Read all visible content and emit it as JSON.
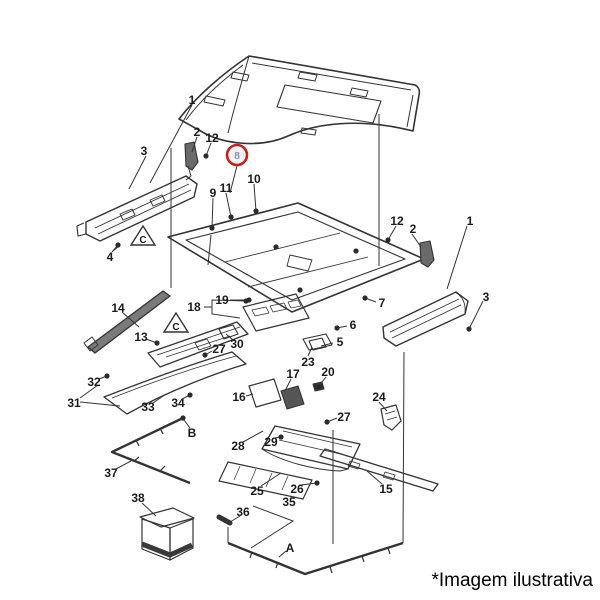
{
  "page": {
    "caption": "*Imagem ilustrativa",
    "background": "#ffffff"
  },
  "diagram": {
    "stroke_color": "#333333",
    "label_color": "#1b1b1b",
    "highlight": {
      "label": "8",
      "cx": 237,
      "cy": 155,
      "r": 10,
      "ring_color": "#c4201d",
      "fill": "#f2f3f5",
      "text_color": "#8795aa"
    },
    "triangles": [
      {
        "label": "C",
        "cx": 143,
        "cy": 237
      },
      {
        "label": "C",
        "cx": 176,
        "cy": 324
      }
    ],
    "callouts": [
      {
        "label": "1",
        "x": 192,
        "y": 100
      },
      {
        "label": "3",
        "x": 144,
        "y": 151
      },
      {
        "label": "2",
        "x": 197,
        "y": 132
      },
      {
        "label": "12",
        "x": 212,
        "y": 138
      },
      {
        "label": "9",
        "x": 213,
        "y": 193
      },
      {
        "label": "11",
        "x": 226,
        "y": 188
      },
      {
        "label": "10",
        "x": 254,
        "y": 179
      },
      {
        "label": "4",
        "x": 110,
        "y": 257
      },
      {
        "label": "12",
        "x": 397,
        "y": 221
      },
      {
        "label": "2",
        "x": 413,
        "y": 229
      },
      {
        "label": "1",
        "x": 470,
        "y": 221
      },
      {
        "label": "3",
        "x": 486,
        "y": 297
      },
      {
        "label": "7",
        "x": 382,
        "y": 303
      },
      {
        "label": "19",
        "x": 222,
        "y": 300
      },
      {
        "label": "18",
        "x": 194,
        "y": 307
      },
      {
        "label": "14",
        "x": 118,
        "y": 308
      },
      {
        "label": "13",
        "x": 141,
        "y": 337
      },
      {
        "label": "30",
        "x": 237,
        "y": 344
      },
      {
        "label": "27",
        "x": 219,
        "y": 349
      },
      {
        "label": "6",
        "x": 353,
        "y": 325
      },
      {
        "label": "5",
        "x": 340,
        "y": 342
      },
      {
        "label": "23",
        "x": 308,
        "y": 362
      },
      {
        "label": "20",
        "x": 328,
        "y": 372
      },
      {
        "label": "17",
        "x": 293,
        "y": 374
      },
      {
        "label": "16",
        "x": 239,
        "y": 397
      },
      {
        "label": "24",
        "x": 379,
        "y": 397
      },
      {
        "label": "27",
        "x": 344,
        "y": 417
      },
      {
        "label": "32",
        "x": 94,
        "y": 382
      },
      {
        "label": "31",
        "x": 74,
        "y": 403
      },
      {
        "label": "33",
        "x": 148,
        "y": 407
      },
      {
        "label": "34",
        "x": 178,
        "y": 403
      },
      {
        "label": "28",
        "x": 238,
        "y": 446
      },
      {
        "label": "29",
        "x": 271,
        "y": 442
      },
      {
        "label": "B",
        "x": 192,
        "y": 433
      },
      {
        "label": "37",
        "x": 111,
        "y": 473
      },
      {
        "label": "38",
        "x": 138,
        "y": 498
      },
      {
        "label": "25",
        "x": 257,
        "y": 491
      },
      {
        "label": "26",
        "x": 297,
        "y": 489
      },
      {
        "label": "35",
        "x": 289,
        "y": 502
      },
      {
        "label": "36",
        "x": 243,
        "y": 512
      },
      {
        "label": "A",
        "x": 290,
        "y": 548
      },
      {
        "label": "15",
        "x": 386,
        "y": 489
      }
    ],
    "leaders": [
      {
        "pts": [
          [
            192,
            105
          ],
          [
            150,
            183
          ]
        ]
      },
      {
        "pts": [
          [
            146,
            156
          ],
          [
            129,
            189
          ]
        ]
      },
      {
        "pts": [
          [
            197,
            137
          ],
          [
            192,
            152
          ]
        ]
      },
      {
        "pts": [
          [
            211,
            143
          ],
          [
            206,
            156
          ]
        ],
        "dot": true
      },
      {
        "pts": [
          [
            237,
            166
          ],
          [
            230,
            193
          ]
        ]
      },
      {
        "pts": [
          [
            213,
            198
          ],
          [
            212,
            228
          ]
        ],
        "dot": true
      },
      {
        "pts": [
          [
            226,
            193
          ],
          [
            231,
            217
          ]
        ],
        "dot": true
      },
      {
        "pts": [
          [
            254,
            184
          ],
          [
            256,
            211
          ]
        ],
        "dot": true
      },
      {
        "pts": [
          [
            112,
            252
          ],
          [
            118,
            245
          ]
        ],
        "dot": true
      },
      {
        "pts": [
          [
            396,
            226
          ],
          [
            388,
            240
          ]
        ],
        "dot": true
      },
      {
        "pts": [
          [
            412,
            234
          ],
          [
            421,
            247
          ]
        ]
      },
      {
        "pts": [
          [
            467,
            226
          ],
          [
            447,
            289
          ]
        ]
      },
      {
        "pts": [
          [
            483,
            301
          ],
          [
            469,
            329
          ]
        ],
        "dot": true
      },
      {
        "pts": [
          [
            376,
            302
          ],
          [
            365,
            298
          ]
        ],
        "dot": true
      },
      {
        "pts": [
          [
            204,
            307
          ],
          [
            212,
            307
          ],
          [
            212,
            300
          ],
          [
            246,
            301
          ]
        ],
        "dot": true
      },
      {
        "pts": [
          [
            212,
            307
          ],
          [
            212,
            314
          ],
          [
            240,
            318
          ]
        ]
      },
      {
        "pts": [
          [
            230,
            300
          ],
          [
            249,
            300
          ]
        ],
        "dot": true
      },
      {
        "pts": [
          [
            122,
            312
          ],
          [
            139,
            327
          ]
        ]
      },
      {
        "pts": [
          [
            146,
            339
          ],
          [
            157,
            343
          ]
        ],
        "dot": true
      },
      {
        "pts": [
          [
            233,
            340
          ],
          [
            226,
            334
          ]
        ]
      },
      {
        "pts": [
          [
            212,
            351
          ],
          [
            205,
            355
          ]
        ],
        "dot": true
      },
      {
        "pts": [
          [
            347,
            326
          ],
          [
            337,
            328
          ]
        ],
        "dot": true
      },
      {
        "pts": [
          [
            333,
            343
          ],
          [
            321,
            346
          ]
        ]
      },
      {
        "pts": [
          [
            308,
            356
          ],
          [
            312,
            347
          ]
        ]
      },
      {
        "pts": [
          [
            326,
            377
          ],
          [
            318,
            387
          ]
        ],
        "dot": true
      },
      {
        "pts": [
          [
            291,
            379
          ],
          [
            285,
            391
          ]
        ]
      },
      {
        "pts": [
          [
            246,
            396
          ],
          [
            253,
            394
          ]
        ]
      },
      {
        "pts": [
          [
            379,
            402
          ],
          [
            387,
            411
          ]
        ]
      },
      {
        "pts": [
          [
            337,
            418
          ],
          [
            327,
            422
          ]
        ],
        "dot": true
      },
      {
        "pts": [
          [
            99,
            379
          ],
          [
            107,
            376
          ]
        ],
        "dot": true
      },
      {
        "pts": [
          [
            80,
            398
          ],
          [
            98,
            385
          ]
        ]
      },
      {
        "pts": [
          [
            80,
            402
          ],
          [
            120,
            406
          ]
        ]
      },
      {
        "pts": [
          [
            153,
            403
          ],
          [
            166,
            394
          ]
        ]
      },
      {
        "pts": [
          [
            182,
            399
          ],
          [
            190,
            395
          ]
        ],
        "dot": true
      },
      {
        "pts": [
          [
            243,
            442
          ],
          [
            263,
            431
          ]
        ]
      },
      {
        "pts": [
          [
            275,
            438
          ],
          [
            281,
            437
          ]
        ],
        "dot": true
      },
      {
        "pts": [
          [
            261,
            486
          ],
          [
            281,
            473
          ]
        ]
      },
      {
        "pts": [
          [
            301,
            485
          ],
          [
            317,
            483
          ]
        ],
        "dot": true
      },
      {
        "pts": [
          [
            253,
            506
          ],
          [
            293,
            521
          ],
          [
            251,
            548
          ]
        ]
      },
      {
        "pts": [
          [
            240,
            516
          ],
          [
            230,
            522
          ]
        ]
      },
      {
        "pts": [
          [
            116,
            469
          ],
          [
            131,
            461
          ]
        ]
      },
      {
        "pts": [
          [
            142,
            503
          ],
          [
            156,
            516
          ]
        ]
      },
      {
        "pts": [
          [
            382,
            484
          ],
          [
            367,
            471
          ]
        ]
      },
      {
        "pts": [
          [
            190,
            428
          ],
          [
            184,
            420
          ]
        ]
      },
      {
        "pts": [
          [
            286,
            551
          ],
          [
            279,
            557
          ]
        ]
      },
      {
        "pts": [
          [
            171,
            148
          ],
          [
            171,
            288
          ]
        ]
      },
      {
        "pts": [
          [
            379,
            114
          ],
          [
            379,
            266
          ]
        ]
      },
      {
        "pts": [
          [
            404,
            352
          ],
          [
            403,
            543
          ]
        ]
      },
      {
        "pts": [
          [
            333,
            430
          ],
          [
            333,
            544
          ]
        ]
      }
    ],
    "dots": [
      [
        183,
        418
      ],
      [
        276,
        247
      ],
      [
        356,
        251
      ],
      [
        300,
        290
      ]
    ],
    "shapes": [
      {
        "d": "M179,119 C196,97 222,74 249,56 L415,85 C419,87 420,91 419,95 L413,131 C358,117 314,124 288,136 C259,149 224,143 206,134 Z",
        "w": 1.6
      },
      {
        "d": "M249,56 C242,81 234,108 228,133",
        "w": 1
      },
      {
        "d": "M186,120 C200,101 220,82 243,65",
        "w": 1
      },
      {
        "d": "M252,63 L411,90",
        "w": 1
      },
      {
        "d": "M413,95 L407,127",
        "w": 1
      },
      {
        "d": "M285,85 L381,101 L373,123 L277,107 Z",
        "w": 1.1
      },
      {
        "d": "M206,96 l19,4 l-2,6 l-19,-4 Z",
        "w": 1
      },
      {
        "d": "M233,72 l16,3 l-2,6 l-16,-3 Z",
        "w": 1
      },
      {
        "d": "M300,72 l17,3 l-2,6 l-17,-3 Z",
        "w": 1
      },
      {
        "d": "M352,88 l16,3 l-2,6 l-16,-3 Z",
        "w": 1
      },
      {
        "d": "M302,128 l14,2 l-1,5 l-14,-2 Z",
        "w": 1
      },
      {
        "d": "M86,222 L186,176 L197,184 L194,197 L100,241 L86,234 Z",
        "w": 1.4
      },
      {
        "d": "M95,228 L189,184",
        "w": 0.9
      },
      {
        "d": "M98,234 L191,190",
        "w": 0.9
      },
      {
        "d": "M120,214 l12,-5 l3,6 l-12,5 Z",
        "w": 0.9
      },
      {
        "d": "M150,200 l12,-5 l3,6 l-12,5 Z",
        "w": 0.9
      },
      {
        "d": "M84,223 l-7,3 l1,10 l8,-2",
        "w": 1.1
      },
      {
        "d": "M185,144 l9,-2 l4,20 l-6,8 l-6,-4 Z",
        "w": 1.1,
        "f": "#6a6a6a"
      },
      {
        "d": "M188,166 l3,10 l-5,4",
        "w": 1
      },
      {
        "d": "M113,251 L120,245",
        "w": 1
      },
      {
        "d": "M211,235 L208,265",
        "w": 1
      },
      {
        "d": "M168,237 L298,203 L424,259 L292,312 Z",
        "w": 1.6
      },
      {
        "d": "M186,240 L298,212 L405,259 L292,300 Z",
        "w": 1.1
      },
      {
        "d": "M225,262 L340,233",
        "w": 0.9
      },
      {
        "d": "M248,287 L368,257",
        "w": 0.9
      },
      {
        "d": "M290,255 l22,5 l-4,11 l-21,-5 Z",
        "w": 0.9
      },
      {
        "d": "M243,307 L296,294 L309,318 L256,331 Z",
        "w": 1.2
      },
      {
        "d": "M252,310 l14,-3 l3,6 l-14,3 Z",
        "w": 0.8
      },
      {
        "d": "M270,306 l14,-3 l3,6 l-14,3 Z",
        "w": 0.8
      },
      {
        "d": "M288,302 l10,-2 l3,6 l-10,2 Z",
        "w": 0.8
      },
      {
        "d": "M219,329 l14,-4 l5,9 l-14,5 Z",
        "w": 1.1
      },
      {
        "d": "M88,347 L163,291 L170,296 L95,353 Z",
        "w": 1.3,
        "f": "#7a7a7a"
      },
      {
        "d": "M84,343 l8,-6 l6,8 l-8,6 Z",
        "w": 1
      },
      {
        "d": "M148,353 L237,322 L248,334 L160,367 Z",
        "w": 1.3
      },
      {
        "d": "M157,355 L240,327",
        "w": 0.8
      },
      {
        "d": "M166,357 L230,336",
        "w": 0.8
      },
      {
        "d": "M195,343 l12,-4 l4,7 l-12,4 Z",
        "w": 0.8
      },
      {
        "d": "M104,397 C145,381 192,364 232,352 L246,364 C216,373 168,391 127,414 Z",
        "w": 1.3
      },
      {
        "d": "M112,398 C150,383 196,367 236,356",
        "w": 0.8
      },
      {
        "d": "M303,339 l23,-5 l6,11 l-23,5 Z",
        "w": 1.1
      },
      {
        "d": "M309,341 l13,-3 l4,9 l-13,3 Z",
        "w": 1.1
      },
      {
        "d": "M249,386 l25,-7 l7,21 l-25,7 Z",
        "w": 1.2
      },
      {
        "d": "M281,391 l17,-5 l6,18 l-17,5 Z",
        "w": 1.1,
        "f": "#555555"
      },
      {
        "d": "M313,384 l9,-2 l2,7 l-9,2 Z",
        "w": 1,
        "f": "#333333"
      },
      {
        "d": "M381,409 l15,-4 l5,16 l-9,9 l-8,-5 Z",
        "w": 1.2
      },
      {
        "d": "M385,414 l10,-3",
        "w": 0.8
      },
      {
        "d": "M387,420 l10,-3",
        "w": 0.8
      },
      {
        "d": "M383,327 L456,292 L468,301 L465,314 L396,346 L384,338 Z",
        "w": 1.4
      },
      {
        "d": "M390,332 L459,299",
        "w": 0.9
      },
      {
        "d": "M392,338 L461,305",
        "w": 0.9
      },
      {
        "d": "M455,292 C462,296 466,303 465,313",
        "w": 0.9
      },
      {
        "d": "M420,243 l10,-2 l4,19 l-6,7 l-7,-4 Z",
        "w": 1.1,
        "f": "#6a6a6a"
      },
      {
        "d": "M275,426 L360,444 L348,469 L262,449 Z",
        "w": 1.3
      },
      {
        "d": "M283,431 L352,447",
        "w": 0.8
      },
      {
        "d": "M279,440 L345,455",
        "w": 0.8
      },
      {
        "d": "M262,449 C282,462 315,470 340,471 L348,469",
        "w": 1
      },
      {
        "d": "M228,462 L312,480 L303,499 L219,481 Z",
        "w": 1.2
      },
      {
        "d": "M240,466 l-6,14",
        "w": 0.7
      },
      {
        "d": "M256,469 l-6,14",
        "w": 0.7
      },
      {
        "d": "M272,473 l-6,14",
        "w": 0.7
      },
      {
        "d": "M288,476 l-6,14",
        "w": 0.7
      },
      {
        "d": "M320,456 L325,449 L438,484 L433,491 Z",
        "w": 1.3
      },
      {
        "d": "M350,461 l10,3 l-2,5 l-10,-3 Z",
        "w": 0.8
      },
      {
        "d": "M385,472 l10,3 l-2,5 l-10,-3 Z",
        "w": 0.8
      },
      {
        "d": "M140,517 L173,508 L194,518 L161,527 Z",
        "w": 1.2
      },
      {
        "d": "M142,519 L142,549 L170,560 L170,528 Z",
        "w": 1.2
      },
      {
        "d": "M170,528 L193,519 L193,548 L170,560 Z",
        "w": 1.2
      },
      {
        "d": "M142,544 L170,555 L192,545",
        "w": 5,
        "s": "#3a3a3a"
      },
      {
        "d": "M219,517 l11,6",
        "w": 5,
        "cap": "round"
      },
      {
        "d": "M228,527 L228,543",
        "w": 1
      },
      {
        "d": "M183,418 L112,452 L190,483",
        "w": 2.4
      },
      {
        "d": "M160,428 l3,6",
        "w": 1.2
      },
      {
        "d": "M136,440 l3,6",
        "w": 1.2
      },
      {
        "d": "M134,461 l5,-4",
        "w": 1.2
      },
      {
        "d": "M160,471 l5,-5",
        "w": 1.2
      },
      {
        "d": "M228,543 L305,574 L403,543",
        "w": 2.4
      },
      {
        "d": "M252,552 l-2,6",
        "w": 1.2
      },
      {
        "d": "M278,562 l-2,6",
        "w": 1.2
      },
      {
        "d": "M330,567 l2,6",
        "w": 1.2
      },
      {
        "d": "M362,556 l2,6",
        "w": 1.2
      },
      {
        "d": "M388,548 l2,6",
        "w": 1.2
      }
    ]
  }
}
